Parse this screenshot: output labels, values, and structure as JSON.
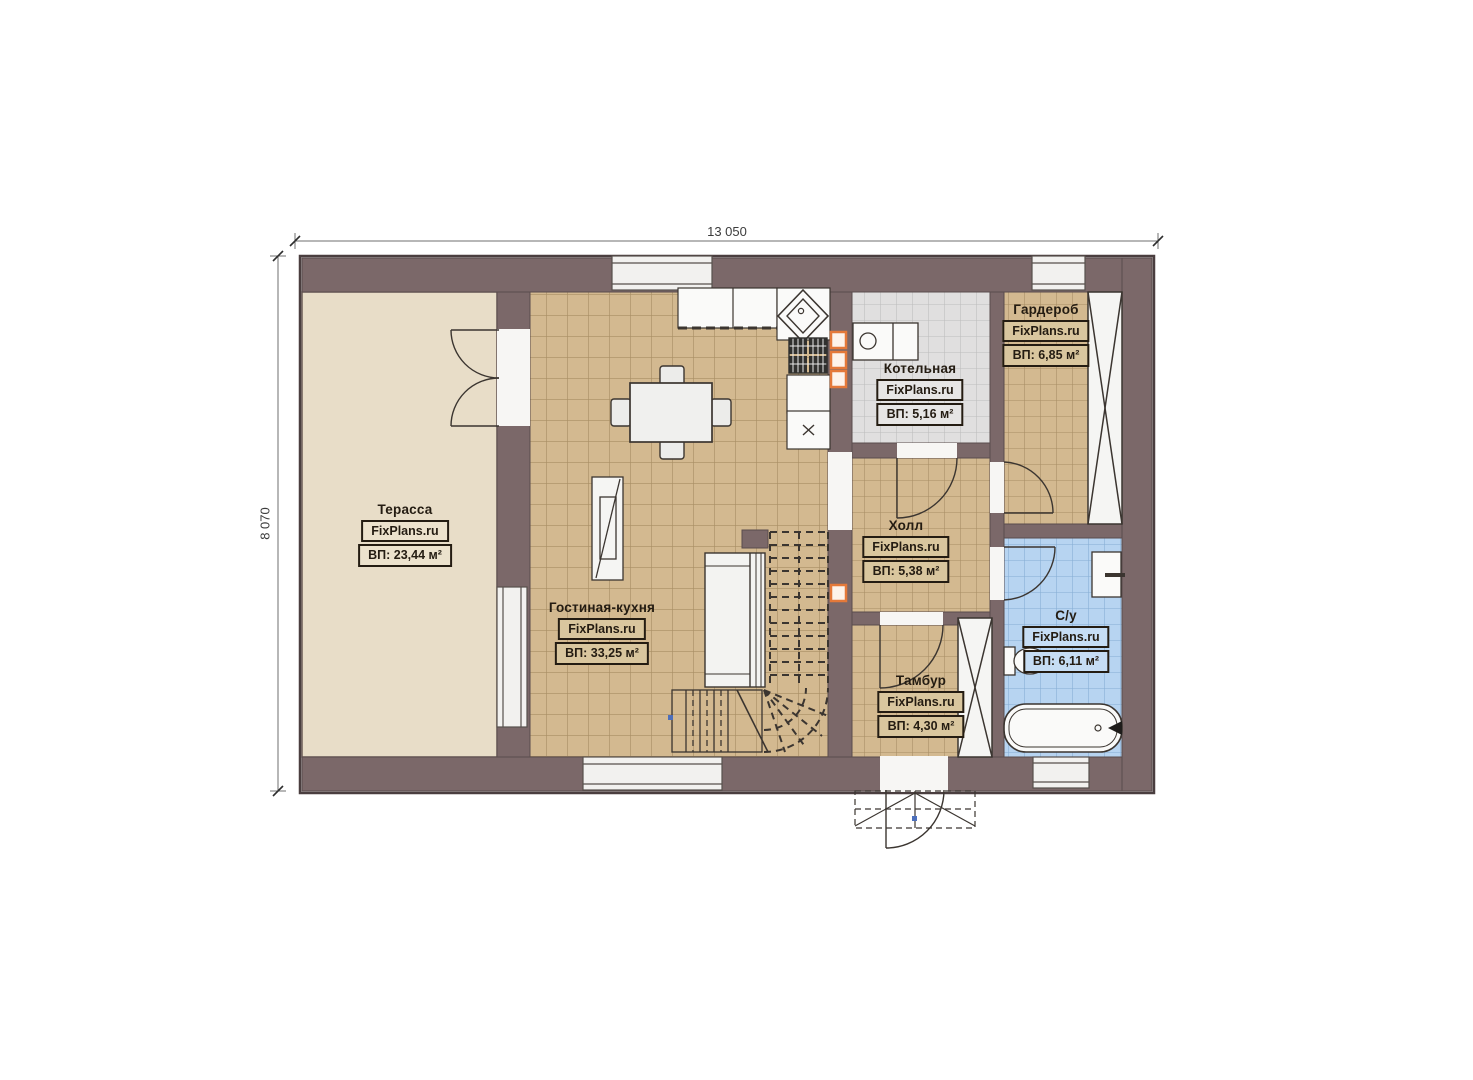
{
  "watermark": "FixPlans.ru",
  "dimensions": {
    "top": "13 050",
    "left": "8 070"
  },
  "rooms": [
    {
      "name": "Терасса",
      "area": "ВП: 23,44 м²"
    },
    {
      "name": "Гостиная-кухня",
      "area": "ВП: 33,25 м²"
    },
    {
      "name": "Котельная",
      "area": "ВП: 5,16 м²"
    },
    {
      "name": "Гардероб",
      "area": "ВП: 6,85 м²"
    },
    {
      "name": "Холл",
      "area": "ВП: 5,38 м²"
    },
    {
      "name": "С/у",
      "area": "ВП: 6,11 м²"
    },
    {
      "name": "Тамбур",
      "area": "ВП: 4,30 м²"
    }
  ],
  "colors": {
    "wall": "#7b6869",
    "wall_outline": "#4a3e3f",
    "floor_tan": "#d3b990",
    "floor_terrace": "#e8ddc8",
    "floor_grey": "#e0dfdf",
    "floor_blue": "#b7d4f1",
    "accent_orange": "#e4793a",
    "label_text": "#241c12"
  }
}
